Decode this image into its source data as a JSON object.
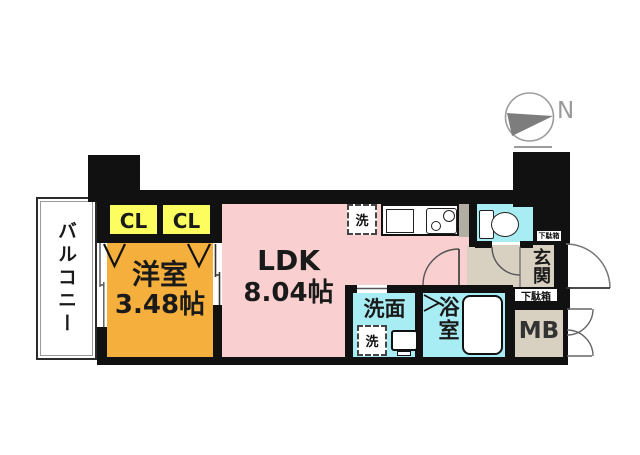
{
  "plan_type": "apartment-floor-plan",
  "compass": {
    "north_label": "N"
  },
  "rooms": {
    "balcony": {
      "label": "バルコニー"
    },
    "closet_left": {
      "label": "CL"
    },
    "closet_right": {
      "label": "CL"
    },
    "western_room": {
      "name": "洋室",
      "size": "3.48帖"
    },
    "ldk": {
      "name": "LDK",
      "size": "8.04帖"
    },
    "washroom": {
      "label": "洗面"
    },
    "bathroom": {
      "label": "浴室"
    },
    "entrance": {
      "label": "玄関"
    },
    "meter_box": {
      "label": "MB"
    },
    "shoe_cabinet": {
      "label": "下駄箱"
    },
    "shoe_cabinet_upper": {
      "label": "下駄箱"
    }
  },
  "fixtures": {
    "washer_space_kitchen": {
      "label": "洗"
    },
    "washer_space_washroom": {
      "label": "洗"
    }
  },
  "colors": {
    "wall": "#111111",
    "ldk_pink": "#F9CFCF",
    "western_orange": "#F4AF3D",
    "closet_yellow": "#FDFD60",
    "wet_cyan": "#A9EDF4",
    "hall_beige": "#D8D0C0",
    "compass_gray": "#7D7D7D"
  }
}
